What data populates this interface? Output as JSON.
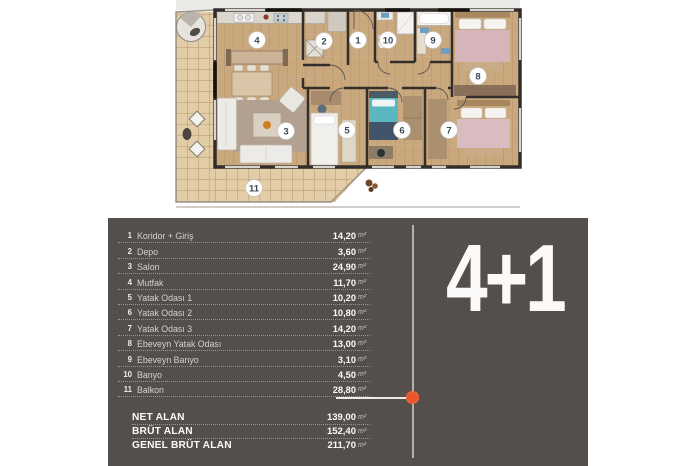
{
  "plan": {
    "room_labels": {
      "r1": "1",
      "r2": "2",
      "r3": "3",
      "r4": "4",
      "r5": "5",
      "r6": "6",
      "r7": "7",
      "r8": "8",
      "r9": "9",
      "r10": "10",
      "r11": "11"
    },
    "colors": {
      "floor_wood": "#c9a87e",
      "balcony_tile": "#e3cda6",
      "wall": "#332e29"
    }
  },
  "panel": {
    "bg": "#544f4b",
    "accent": "#e8552a",
    "type_label": "4+1",
    "unit": "m²",
    "rooms": [
      {
        "num": "1",
        "label": "Koridor + Giriş",
        "value": "14,20"
      },
      {
        "num": "2",
        "label": "Depo",
        "value": "3,60"
      },
      {
        "num": "3",
        "label": "Salon",
        "value": "24,90"
      },
      {
        "num": "4",
        "label": "Mutfak",
        "value": "11,70"
      },
      {
        "num": "5",
        "label": "Yatak Odası 1",
        "value": "10,20"
      },
      {
        "num": "6",
        "label": "Yatak Odası 2",
        "value": "10,80"
      },
      {
        "num": "7",
        "label": "Yatak Odası 3",
        "value": "14,20"
      },
      {
        "num": "8",
        "label": "Ebeveyn Yatak Odası",
        "value": "13,00"
      },
      {
        "num": "9",
        "label": "Ebeveyn Banyo",
        "value": "3,10"
      },
      {
        "num": "10",
        "label": "Banyo",
        "value": "4,50"
      },
      {
        "num": "11",
        "label": "Balkon",
        "value": "28,80"
      }
    ],
    "summary": [
      {
        "label": "NET ALAN",
        "value": "139,00"
      },
      {
        "label": "BRÜT ALAN",
        "value": "152,40"
      },
      {
        "label": "GENEL BRÜT ALAN",
        "value": "211,70"
      }
    ]
  }
}
